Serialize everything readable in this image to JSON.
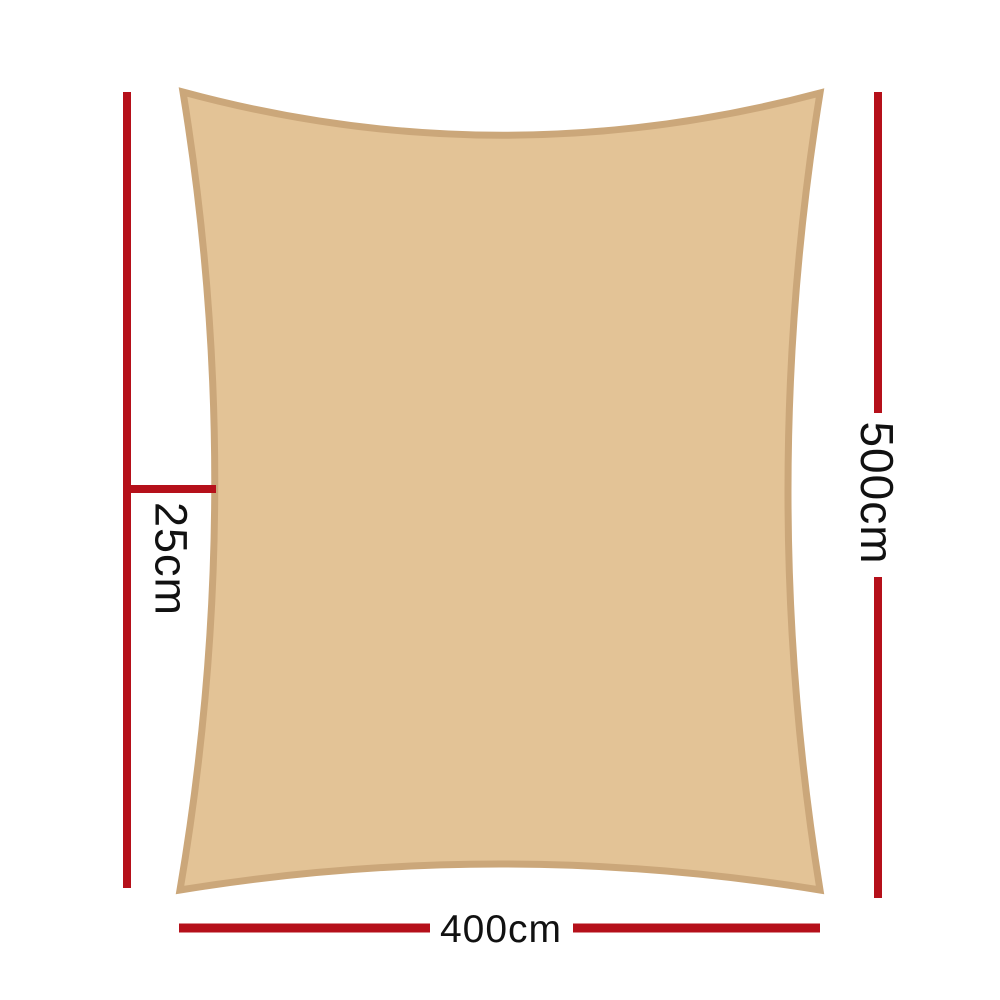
{
  "diagram": {
    "name": "shade sail dimension diagram",
    "canvas": {
      "width": 1000,
      "height": 1000,
      "background_color": "#ffffff"
    },
    "sail": {
      "kind": "rectangle shade sail with concave edges",
      "fill_color": "#e3c396",
      "border_color": "#cba77a"
    },
    "dimension_style": {
      "line_color": "#b5101a",
      "text_color": "#111111"
    },
    "dimensions": {
      "height": {
        "label": "500cm",
        "side": "right",
        "orientation": "vertical"
      },
      "width": {
        "label": "400cm",
        "side": "bottom",
        "orientation": "horizontal"
      },
      "edge_offset": {
        "label": "25cm",
        "side": "left",
        "orientation": "vertical"
      }
    }
  }
}
